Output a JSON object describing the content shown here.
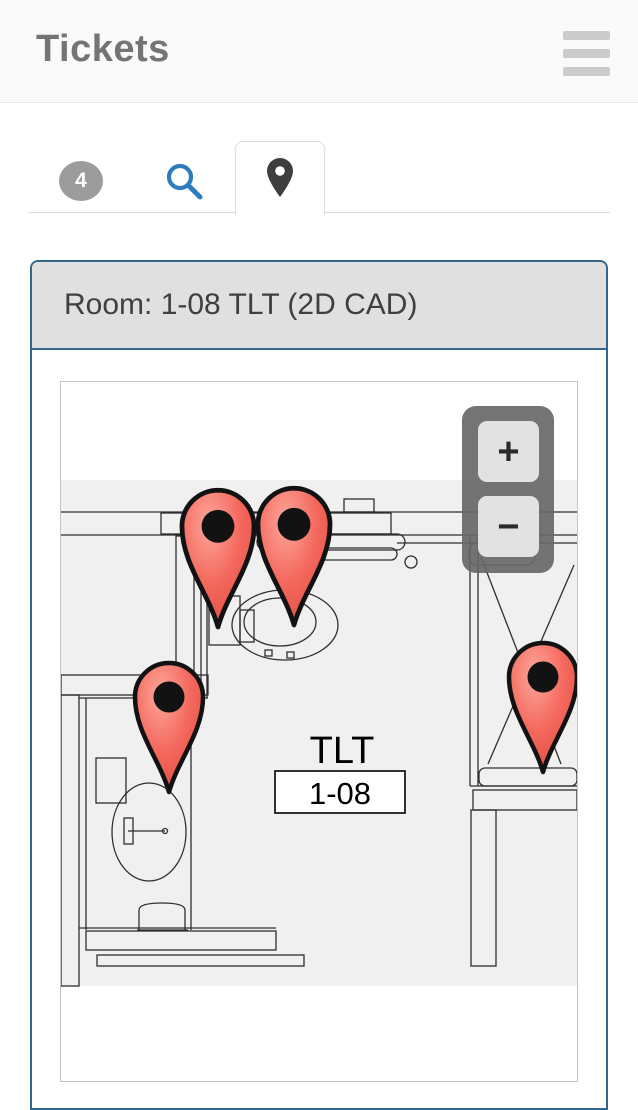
{
  "header": {
    "title": "Tickets"
  },
  "tabs": {
    "badge_count": "4"
  },
  "panel": {
    "title": "Room: 1-08 TLT (2D CAD)"
  },
  "map": {
    "room_label": "TLT",
    "room_number": "1-08",
    "zoom_in_label": "+",
    "zoom_out_label": "−",
    "pins": [
      {
        "id": "pin-1",
        "transform": "translate(157,245) scale(1.06)"
      },
      {
        "id": "pin-2",
        "transform": "translate(233,243) scale(1.06)"
      },
      {
        "id": "pin-3",
        "transform": "translate(108,410)"
      },
      {
        "id": "pin-4",
        "transform": "translate(482,390)"
      }
    ]
  },
  "colors": {
    "accent_blue": "#2e7cbe",
    "panel_border": "#31678c",
    "pin_red": "#f05448",
    "badge_gray": "#9c9c9c"
  }
}
